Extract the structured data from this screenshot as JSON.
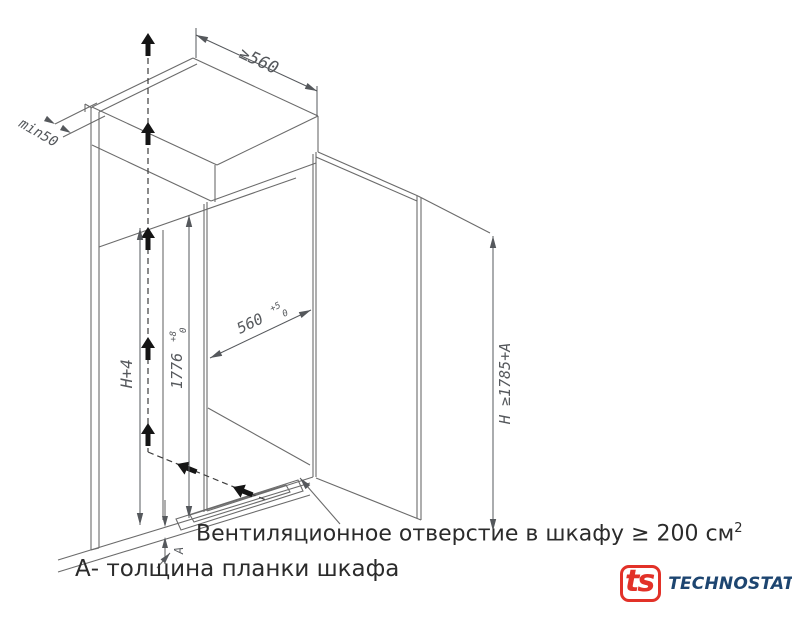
{
  "diagram": {
    "dim_top_width": "≥560",
    "dim_wall_gap": "min50",
    "dim_height_plus": "H+4",
    "dim_inner_height": {
      "base": "1776",
      "tol_plus": "+8",
      "tol_minus": "0"
    },
    "dim_inner_width": {
      "base": "560",
      "tol_plus": "+5",
      "tol_minus": "0"
    },
    "dim_total_height": "H ≥1785+A",
    "dim_plank": "A"
  },
  "captions": {
    "vent_text": "Вентиляционное отверстие в шкафу ≥ 200 см",
    "vent_sup": "2",
    "legend_a": "А- толщина планки шкафа"
  },
  "logo": {
    "mark": "ts",
    "name": "TECHNOSTATUS"
  },
  "colors": {
    "line": "#6b6b6b",
    "dim_text": "#55585c",
    "caption": "#2b2b2b",
    "flow_arrow": "#151515",
    "logo_red": "#e23128",
    "logo_navy": "#1d4570"
  }
}
